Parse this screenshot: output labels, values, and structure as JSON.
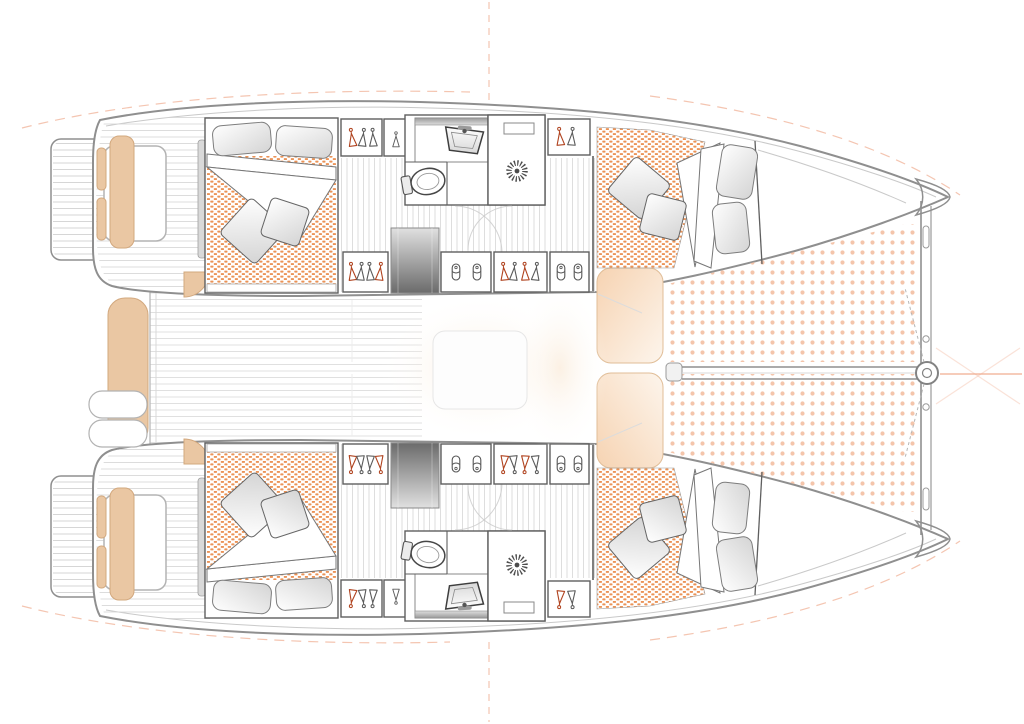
{
  "meta": {
    "title": "Catamaran interior layout deck plan, bow pointing right, four double cabins and two bathrooms",
    "drawing_type": "floor-plan",
    "visible_text": []
  },
  "colors": {
    "paper": "#ffffff",
    "line": "#8f8f8f",
    "line_light": "#c9c9c9",
    "wall": "#5f5f5f",
    "hatch": "#d6d6d6",
    "fixture": "#4c4c4c",
    "mattress_dot": "#e8803a",
    "trampoline_dot": "#f4c5ab",
    "cushion": "#eac7a3",
    "cushion_edge": "#d2a87e",
    "seat_glow": "#f6d3b2",
    "stair_light": "#e0e0e0",
    "stair_dark": "#6b6b6b",
    "hanger_accent": "#b0431f",
    "guide": "#f0ad90"
  },
  "inventory": {
    "hulls": 2,
    "double_cabins": 4,
    "double_beds": 4,
    "bathrooms": 2,
    "showers": 2,
    "toilets": 2,
    "washbasins": 2,
    "wardrobes": 10,
    "shoe_lockers": 4,
    "companionway_stairs": 2,
    "trampoline_panels": 2,
    "helm_seats": 2,
    "cockpit_benches": 1,
    "foredeck_seats": 2,
    "swim_platforms": 2
  },
  "areas": {
    "boat": {
      "label": "Catamaran deck plan, bow to the right, stern to the left"
    },
    "port_hull": {
      "label": "Port hull (top): aft cabin, bathroom, corridor, forward cabin"
    },
    "starboard_hull": {
      "label": "Starboard hull (bottom): mirrored layout of the port hull"
    },
    "swim_platform": {
      "label": "Swim platform with steps at the stern"
    },
    "helm_seat": {
      "label": "Helm seat with tan cushions"
    },
    "aft_cabin": {
      "label": "Aft double cabin with dotted mattress, pillows, folded duvet and throw cushions"
    },
    "forward_cabin": {
      "label": "Forward double cabin with dotted mattress, pillows, folded duvet and throw cushions"
    },
    "bathroom": {
      "label": "Bathroom with vanity counter, washbasin and toilet"
    },
    "shower": {
      "label": "Shower stall with drain rosette"
    },
    "wardrobe": {
      "label": "Wardrobe locker with clothes hangers"
    },
    "shoe_locker": {
      "label": "Shoe locker"
    },
    "companionway": {
      "label": "Companionway steps down into the hull"
    },
    "corridor": {
      "label": "Hull corridor with plank flooring"
    },
    "aft_cockpit": {
      "label": "Aft cockpit with bench seat and davits"
    },
    "salon": {
      "label": "Bridgedeck salon (overexposed white area with faint table)"
    },
    "foredeck_seat": {
      "label": "Forward cockpit lounge seat"
    },
    "trampoline": {
      "label": "Bow trampoline net between the hulls"
    },
    "bow_rig": {
      "label": "Forward crossbeam, bowsprit longeron and furler drum"
    },
    "registration": {
      "label": "Light orange drawing registration and centerline marks"
    }
  },
  "icons": [
    {
      "name": "hanger-icon",
      "depicts": "clothes hanger"
    },
    {
      "name": "shoe-icon",
      "depicts": "shoe seen from above"
    },
    {
      "name": "shower-drain-icon",
      "depicts": "shower drain rosette"
    },
    {
      "name": "toilet-icon",
      "depicts": "marine toilet"
    },
    {
      "name": "washbasin-icon",
      "depicts": "washbasin with faucet"
    },
    {
      "name": "furler-icon",
      "depicts": "forestay furler drum"
    }
  ]
}
